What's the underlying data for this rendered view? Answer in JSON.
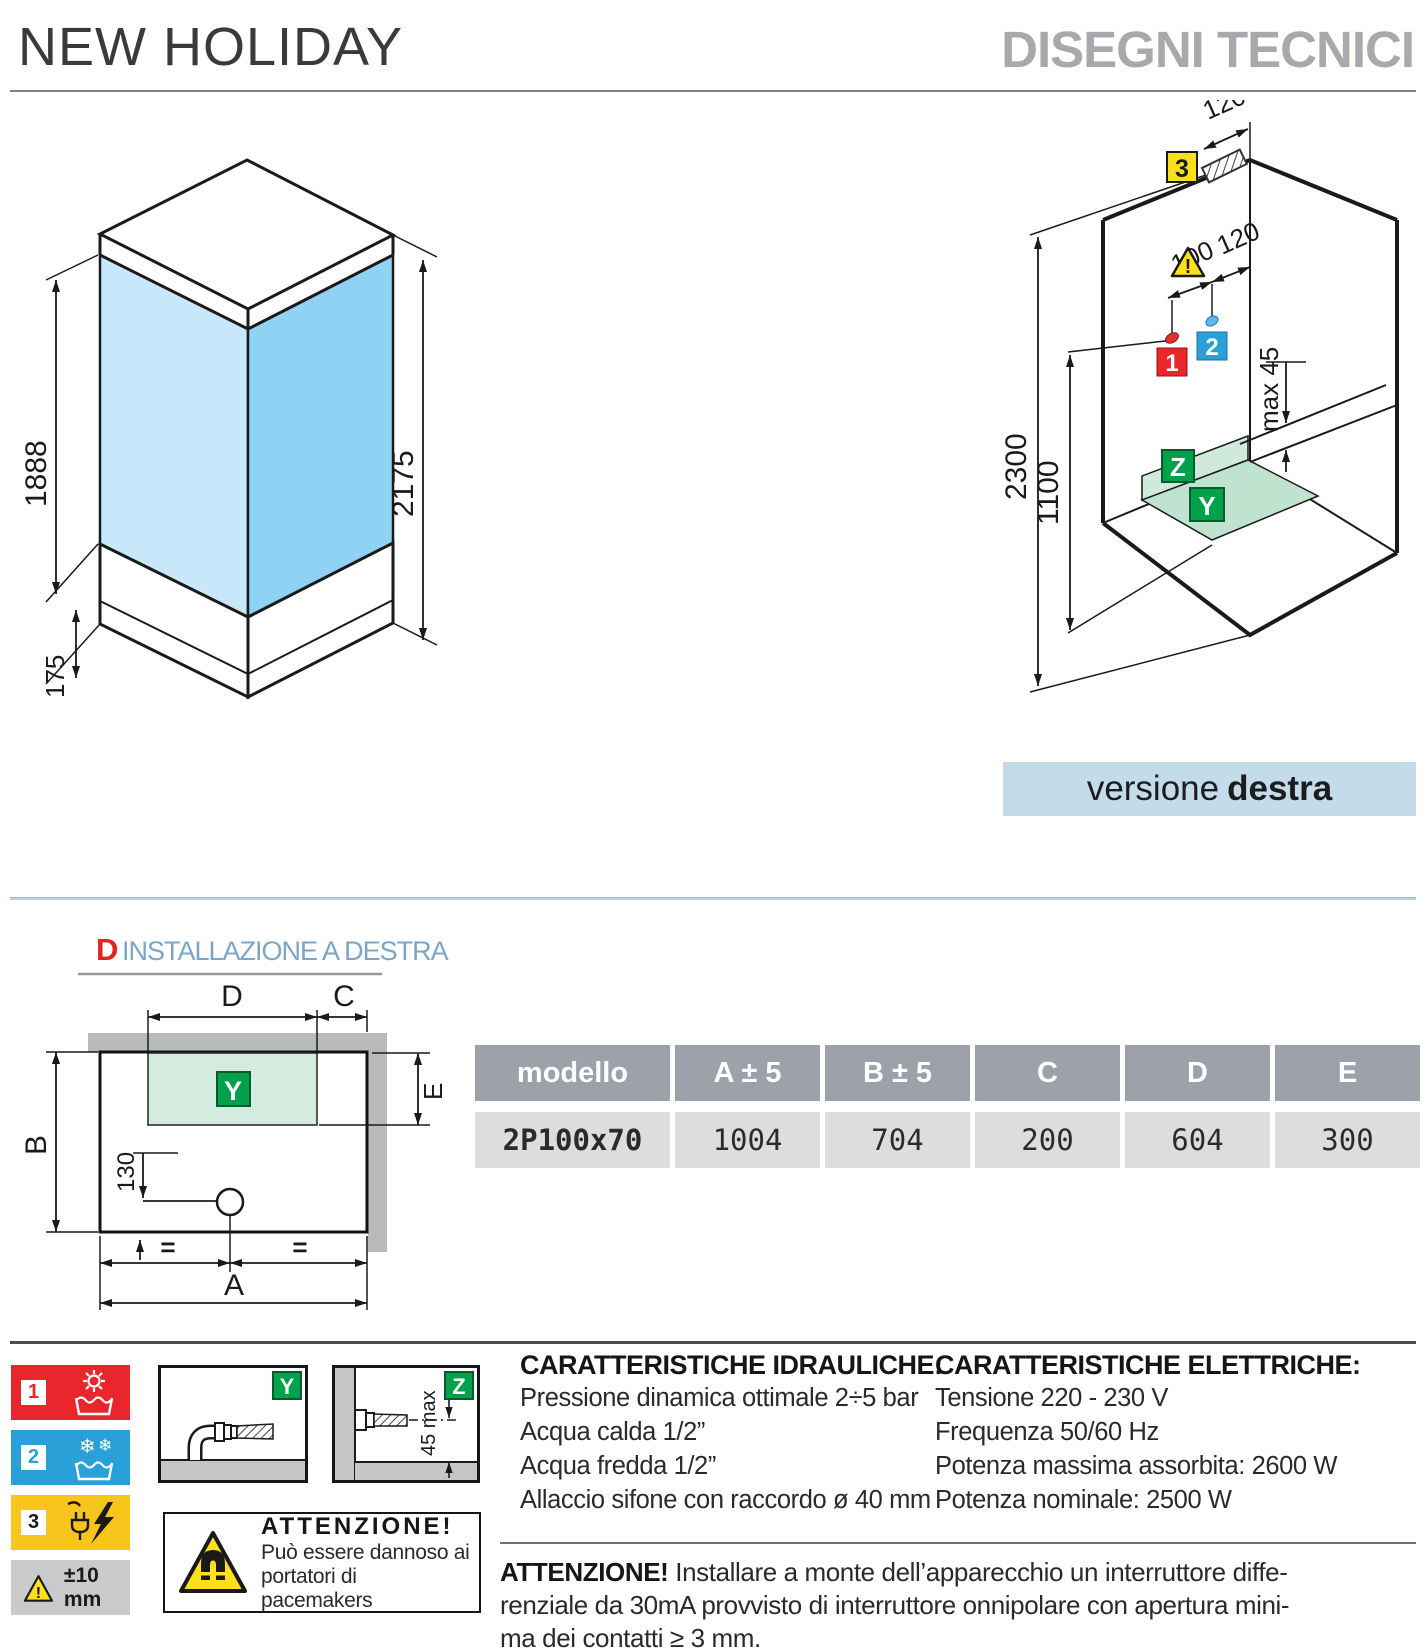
{
  "header": {
    "title": "NEW HOLIDAY",
    "subtitle": "DISEGNI TECNICI"
  },
  "iso": {
    "dim_glass": "1888",
    "dim_tray": "175",
    "dim_total": "2175"
  },
  "axon": {
    "dim_top": "120",
    "dim_hot": "100",
    "dim_cold": "120",
    "dim_height": "2300",
    "dim_mixer": "1100",
    "dim_ledge": "max 45",
    "label_1": "1",
    "label_2": "2",
    "label_3": "3",
    "label_y": "Y",
    "label_z": "Z",
    "caption_normal": "versione",
    "caption_bold": "destra"
  },
  "plan": {
    "letter": "D",
    "title": "INSTALLAZIONE A DESTRA",
    "dim_d": "D",
    "dim_c": "C",
    "dim_b": "B",
    "dim_e": "E",
    "dim_a": "A",
    "dim_drain": "130",
    "eq_left": "=",
    "eq_right": "=",
    "label_y": "Y"
  },
  "table": {
    "headers": [
      "modello",
      "A ± 5",
      "B ± 5",
      "C",
      "D",
      "E"
    ],
    "row": {
      "model": "2P100x70",
      "values": [
        "1004",
        "704",
        "200",
        "604",
        "300"
      ]
    }
  },
  "legend": {
    "item1": "1",
    "item2": "2",
    "item3": "3",
    "tolerance": "±10 mm",
    "label_y": "Y",
    "label_z": "Z",
    "dim_z": "45 max"
  },
  "attention_box": {
    "title": "ATTENZIONE!",
    "line1": "Può essere dannoso ai",
    "line2": "portatori di pacemakers"
  },
  "hydraulic": {
    "title": "CARATTERISTICHE IDRAULICHE:",
    "lines": [
      "Pressione dinamica ottimale 2÷5 bar",
      "Acqua calda 1/2”",
      "Acqua fredda 1/2”",
      "Allaccio sifone con raccordo ø 40 mm"
    ]
  },
  "electric": {
    "title": "CARATTERISTICHE ELETTRICHE:",
    "lines": [
      "Tensione 220 - 230 V",
      "Frequenza 50/60 Hz",
      "Potenza massima assorbita: 2600 W",
      "Potenza nominale: 2500 W"
    ]
  },
  "warning": {
    "label": "ATTENZIONE!",
    "text": " Installare a monte dell’apparecchio un interruttore diffe-\nrenziale da 30mA provvisto di interruttore onnipolare con apertura mini-\nma dei contatti ≥ 3 mm."
  },
  "colors": {
    "red": "#e8262b",
    "blue": "#2aa0d8",
    "yellow": "#f7c51b",
    "green": "#00a14b",
    "glass_left": "#c7e8fa",
    "glass_right": "#8fd2f3",
    "bar_blue": "#c4dbe9",
    "table_header": "#9da1aa",
    "table_row": "#dcddde"
  }
}
